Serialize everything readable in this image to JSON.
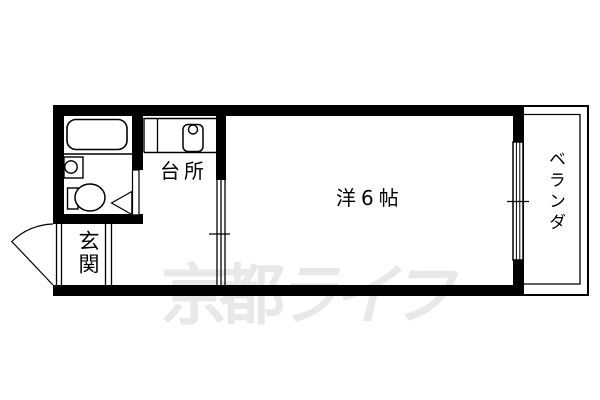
{
  "floorplan": {
    "labels": {
      "kitchen": "台所",
      "main_room": "洋6帖",
      "entrance": "玄関",
      "veranda": "ベランダ"
    },
    "fixtures": [
      "bathtub",
      "wash-basin",
      "toilet",
      "bathroom-door",
      "kitchen-sink",
      "entrance-door",
      "sliding-partition",
      "window",
      "veranda"
    ],
    "colors": {
      "wall": "#000000",
      "line": "#000000",
      "background": "#ffffff",
      "watermark": "#e8e8e8"
    }
  },
  "watermark": {
    "upright": "京都",
    "slanted": "ライフ"
  }
}
